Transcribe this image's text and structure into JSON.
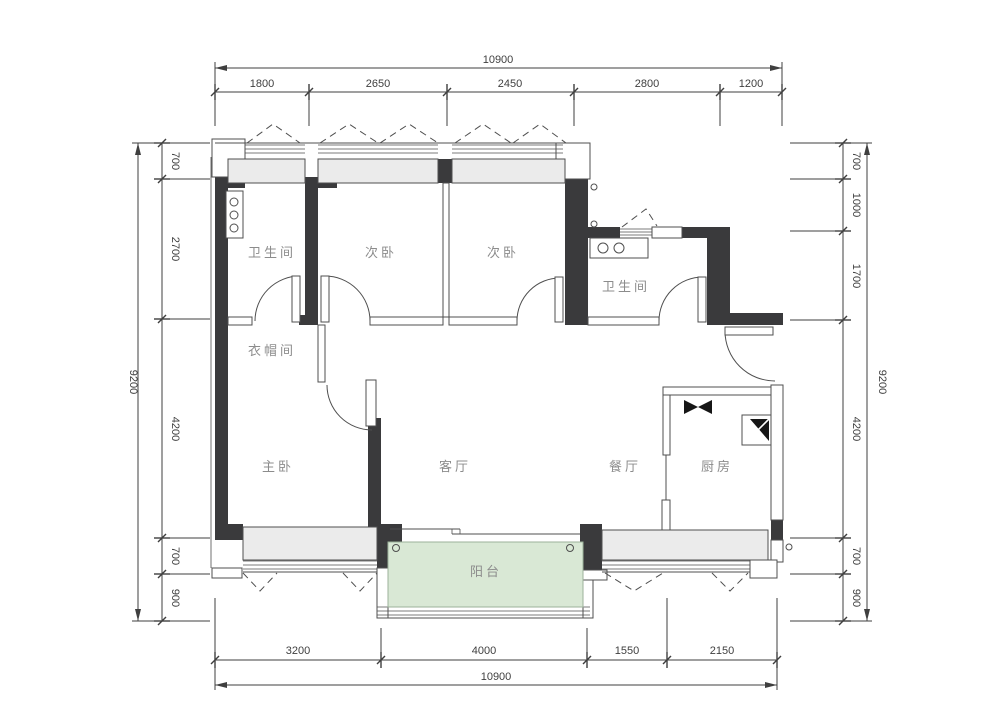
{
  "plan": {
    "rooms": {
      "bath1": "卫生间",
      "bed1": "次卧",
      "bed2": "次卧",
      "bath2": "卫生间",
      "cloak": "衣帽间",
      "master": "主卧",
      "living": "客厅",
      "dining": "餐厅",
      "kitchen": "厨房",
      "balcony": "阳台"
    },
    "dims": {
      "top": {
        "total": "10900",
        "segments": [
          "1800",
          "2650",
          "2450",
          "2800",
          "1200"
        ]
      },
      "bottom": {
        "total": "10900",
        "segments": [
          "3200",
          "4000",
          "1550",
          "2150"
        ]
      },
      "left": {
        "total": "9200",
        "segments": [
          "700",
          "2700",
          "4200",
          "700",
          "900"
        ]
      },
      "right": {
        "total": "9200",
        "segments": [
          "700",
          "1000",
          "1700",
          "4200",
          "700",
          "900"
        ]
      }
    },
    "colors": {
      "wall": "#3a3a3c",
      "line": "#4f4f4f",
      "dim": "#3f3f3f",
      "label": "#8c8c8c",
      "sill": "#ebebeb",
      "balcony": "#d9e8d5"
    }
  }
}
